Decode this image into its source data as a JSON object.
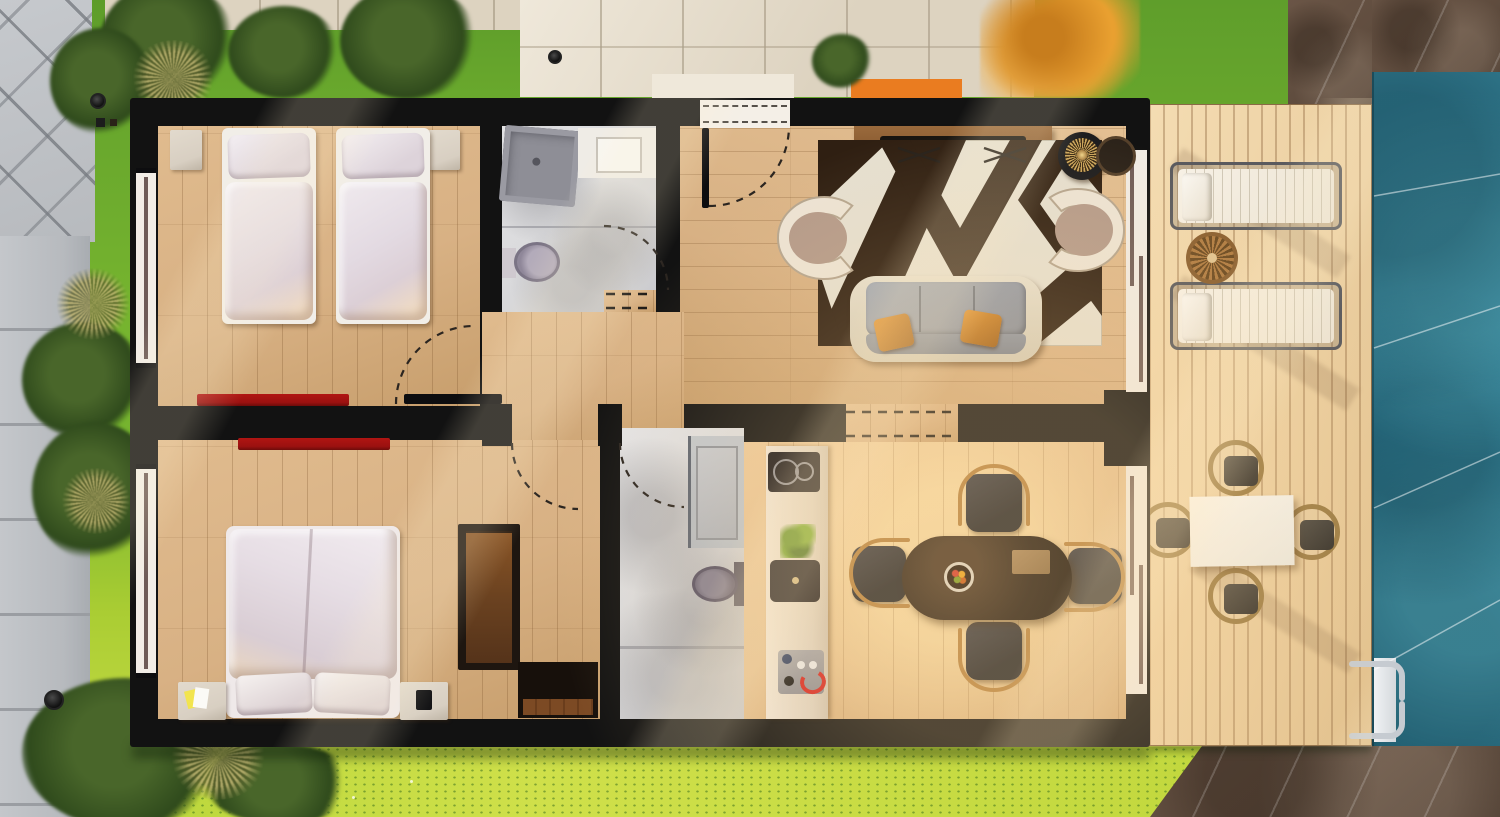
{
  "scene": {
    "type": "3d-rendered-floor-plan-top-view",
    "description": "Single-storey villa rendering seen from above, with garden lawn, paved paths, wooden pool deck and swimming pool"
  },
  "palette": {
    "wall": "#121212",
    "woodFloor": "#d8b184",
    "woodDark": "#c79e6c",
    "deckWood": "#eccfa4",
    "grassBase": "#76b42f",
    "grassDark": "#5f9e2b",
    "grassBright": "#aacd33",
    "grassSun": "#cfe04a",
    "foliage": "#2f4a1c",
    "foliage2": "#49662a",
    "pool": "#2f7f96",
    "paveGray": "#b7babe",
    "paveGrayDark": "#9a9da2",
    "paveBeige": "#ddd3c0",
    "paveBeigeLight": "#efe8da",
    "paveBrown": "#5f4c3e",
    "orange": "#ea7c20",
    "autumn": "#e9a030",
    "marble": "#d9d9db",
    "doorLine": "#6e5b57",
    "redRug": "#9b1110",
    "nightstand": "#d8cfc2",
    "rugDark": "#2f1f12",
    "rugCream": "#e5dfd0",
    "copper": "#b5813f",
    "arcDash": "#2b2520"
  },
  "exterior": {
    "features": [
      {
        "name": "gray-diagonal-walkway",
        "position": "top-left-corner"
      },
      {
        "name": "gray-slab-path",
        "position": "left-edge"
      },
      {
        "name": "stone-tile-path",
        "position": "top-edge"
      },
      {
        "name": "stone-plaza",
        "position": "top-center"
      },
      {
        "name": "entry-walkway",
        "position": "in-front-of-entry-door"
      },
      {
        "name": "orange-planter-box",
        "position": "top-right-of-entry"
      },
      {
        "name": "autumn-tree",
        "position": "top-right-lawn"
      },
      {
        "name": "brown-stone-patio",
        "position": "top-right-corner"
      },
      {
        "name": "brown-stone-patio",
        "position": "bottom-right-corner"
      },
      {
        "name": "lawn",
        "position": "surrounding-house"
      },
      {
        "name": "shrubs",
        "count": 9
      },
      {
        "name": "ornamental-grass-tufts",
        "count": 4
      },
      {
        "name": "garden-spotlights",
        "count": 3
      },
      {
        "name": "swimming-pool",
        "position": "right-edge"
      }
    ]
  },
  "house": {
    "rooms": [
      {
        "id": "bedroom-1",
        "label": "Twin bedroom",
        "position": "top-left",
        "furniture": [
          "single-bed",
          "single-bed",
          "nightstand",
          "nightstand",
          "red-runner-rug"
        ]
      },
      {
        "id": "bathroom-1",
        "label": "Bathroom",
        "position": "top-center",
        "furniture": [
          "corner-shower",
          "vanity-with-sink",
          "toilet"
        ]
      },
      {
        "id": "entry-hall",
        "label": "Entry hall",
        "position": "top-middle",
        "furniture": []
      },
      {
        "id": "living-room",
        "label": "Living room",
        "position": "top-right",
        "furniture": [
          "tv-console",
          "tv",
          "geometric-rug",
          "three-seat-sofa",
          "armchair",
          "armchair",
          "round-lamp-table",
          "round-side-table",
          "throw-pillow",
          "throw-pillow"
        ]
      },
      {
        "id": "bedroom-2",
        "label": "Double bedroom",
        "position": "bottom-left",
        "furniture": [
          "double-bed",
          "nightstand",
          "nightstand",
          "wardrobe",
          "chest",
          "red-runner-rug"
        ]
      },
      {
        "id": "bathroom-2",
        "label": "Shower room",
        "position": "bottom-center",
        "furniture": [
          "walk-in-shower",
          "toilet"
        ]
      },
      {
        "id": "kitchen-dining",
        "label": "Kitchen / dining",
        "position": "bottom-right",
        "furniture": [
          "kitchen-counter",
          "cooktop",
          "kitchen-sink",
          "coffee-machine",
          "potted-plant",
          "dining-table",
          "dining-chair",
          "dining-chair",
          "dining-chair",
          "dining-chair",
          "fruit-bowl",
          "serving-tray"
        ]
      }
    ],
    "openings": [
      "entry-door-with-swing-arc",
      "bedroom-1-door",
      "bedroom-2-door",
      "bathroom-1-door",
      "bathroom-2-door",
      "open-passage-living-to-dining",
      "sliding-door-living-to-deck",
      "sliding-door-dining-to-deck",
      "window-bedroom-1",
      "window-bedroom-2"
    ]
  },
  "deck": {
    "label": "Pool deck",
    "furniture": [
      "sun-lounger",
      "sun-lounger",
      "round-wicker-side-table",
      "outdoor-dining-table",
      "wicker-chair",
      "wicker-chair",
      "wicker-chair",
      "wicker-chair",
      "pool-ladder"
    ]
  }
}
